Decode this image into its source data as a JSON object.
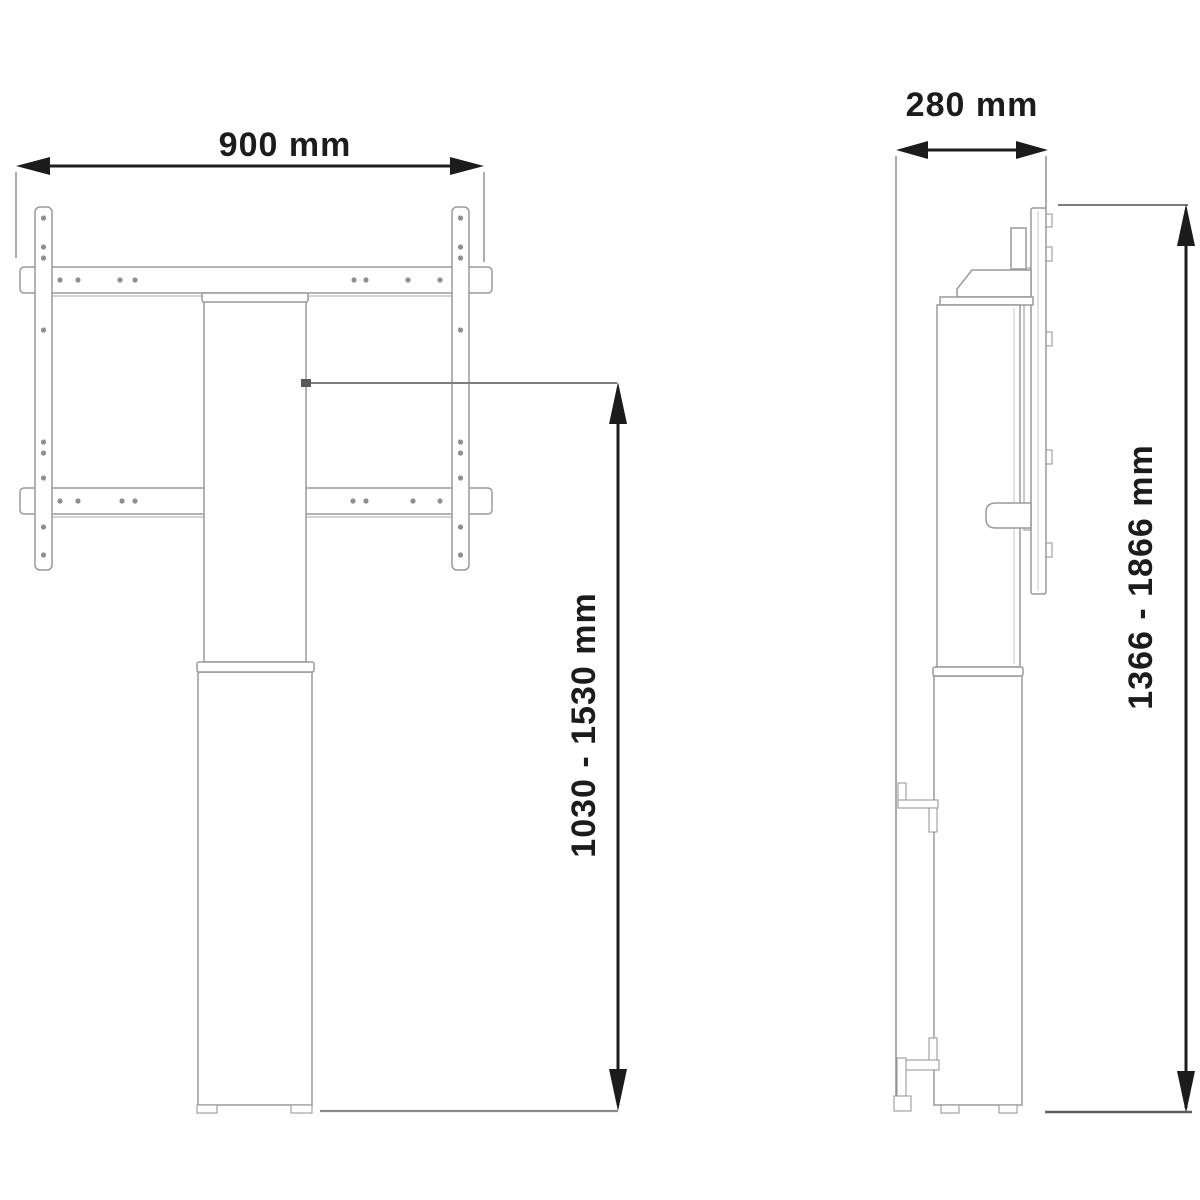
{
  "drawing": {
    "front_view": {
      "width_label": "900 mm",
      "height_label": "1030 - 1530 mm"
    },
    "side_view": {
      "depth_label": "280 mm",
      "height_label": "1366 - 1866 mm"
    },
    "colors": {
      "background": "#ffffff",
      "line": "#9a9a9a",
      "dark_line": "#707070",
      "reference": "#7d7d7d",
      "dimension": "#1c1c1c"
    }
  }
}
